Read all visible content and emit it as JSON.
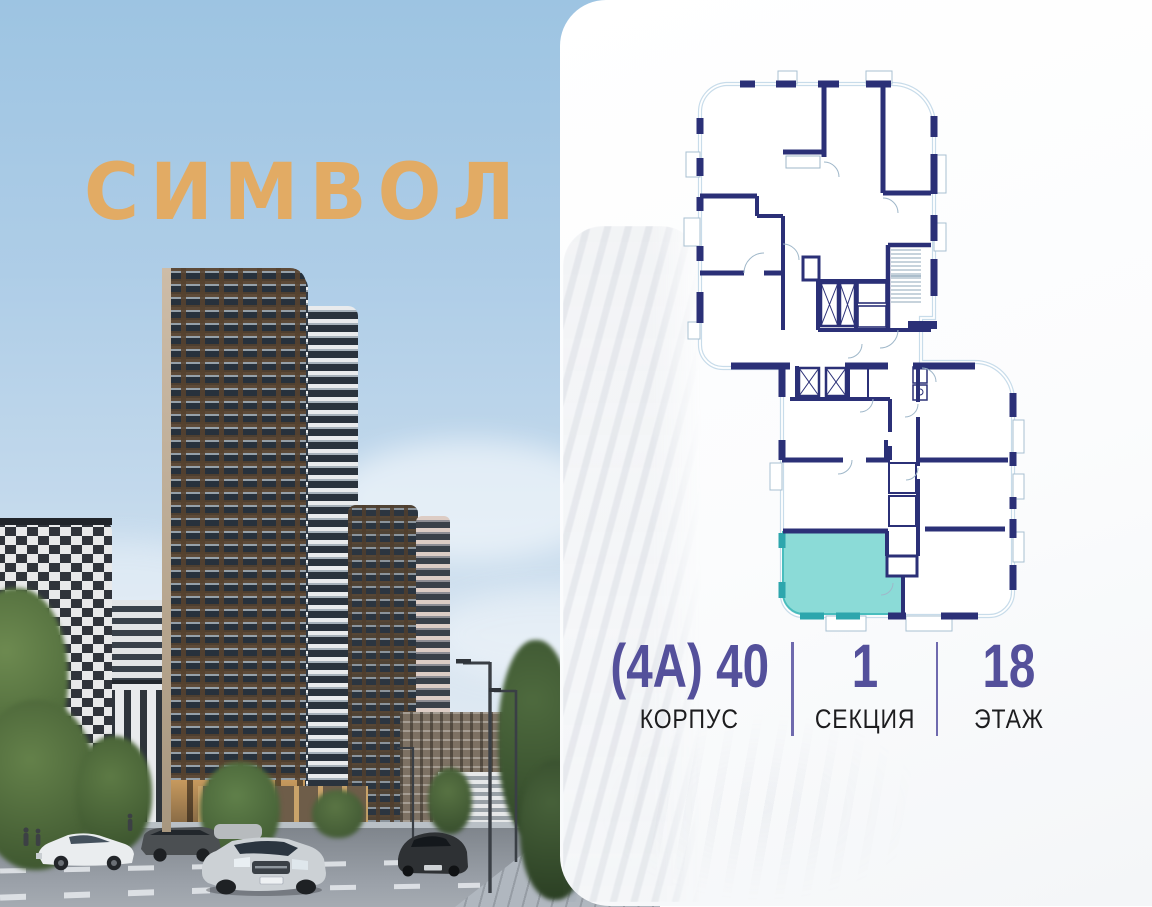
{
  "logo": {
    "text": "СИМВОЛ",
    "color": "#e2ab64"
  },
  "unit_info": {
    "columns": [
      {
        "value": "(4А) 40",
        "label": "КОРПУС"
      },
      {
        "value": "1",
        "label": "СЕКЦИЯ"
      },
      {
        "value": "18",
        "label": "ЭТАЖ"
      }
    ],
    "value_color": "#54509b",
    "label_color": "#1d1d1f",
    "divider_color": "#5f5aa5"
  },
  "floor_plan": {
    "wall_color": "#2b3077",
    "glazing_color": "#c8dcea",
    "highlighted_unit": {
      "fill": "#8bdbd7",
      "stroke": "#2da6ad"
    }
  }
}
